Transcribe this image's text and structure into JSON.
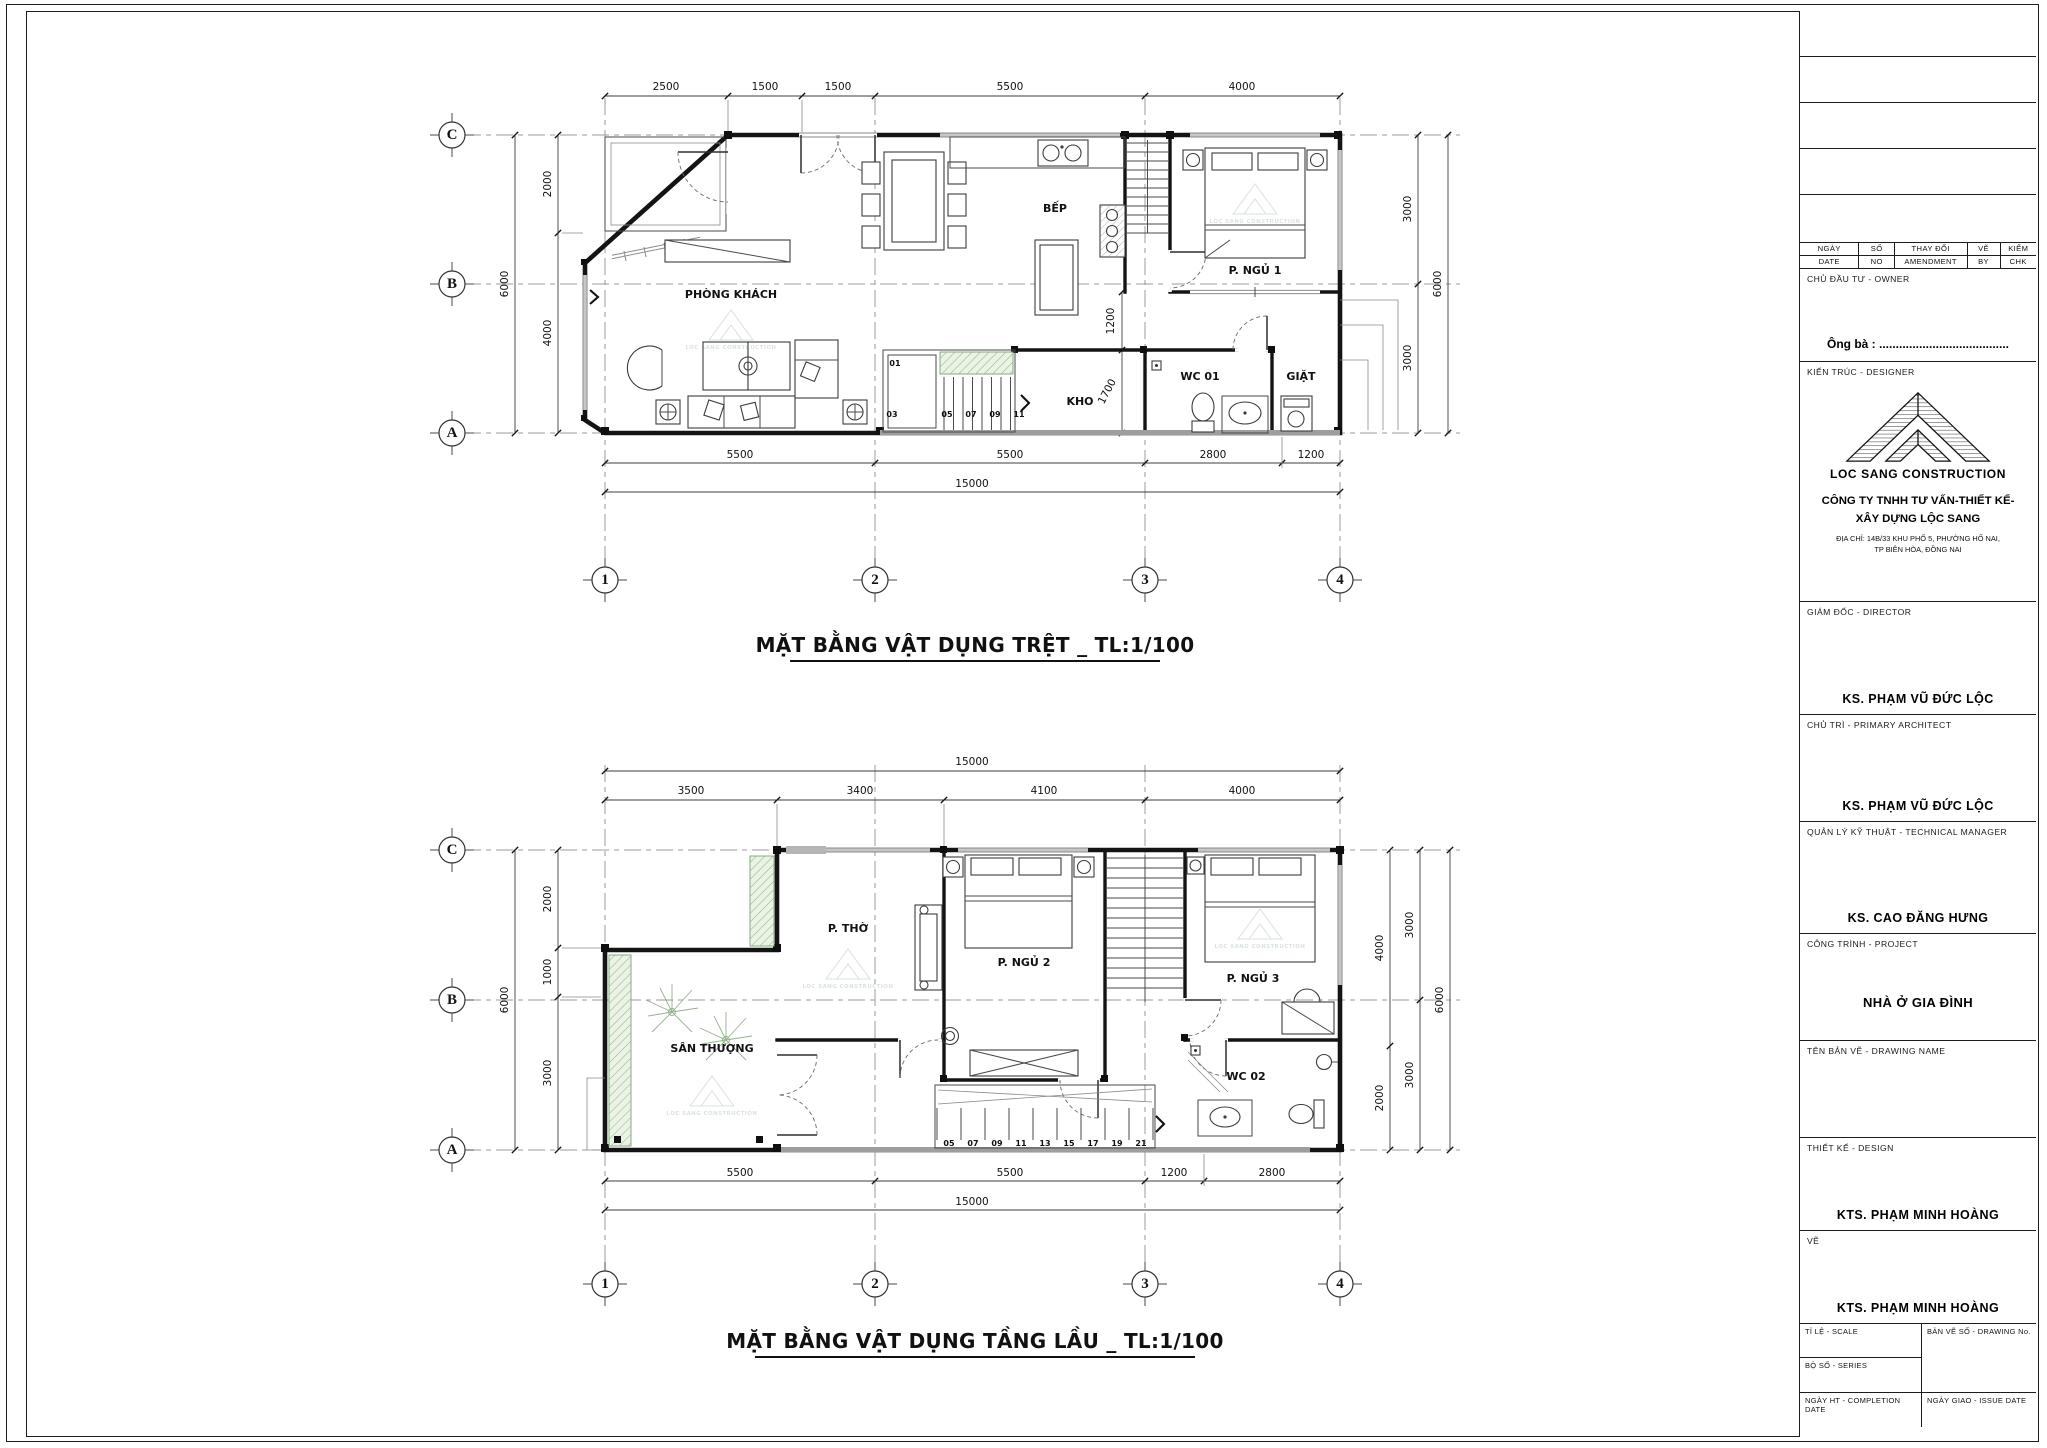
{
  "titles": {
    "plan1": "MẶT BẰNG VẬT DỤNG TRỆT _ TL:1/100",
    "plan2": "MẶT BẰNG VẬT DỤNG TẦNG LẦU _ TL:1/100"
  },
  "watermark": "LOC SANG CONSTRUCTION",
  "grid": {
    "rows": [
      "C",
      "B",
      "A"
    ],
    "cols": [
      "1",
      "2",
      "3",
      "4"
    ]
  },
  "plan1": {
    "rooms": {
      "living": "PHÒNG KHÁCH",
      "kitchen": "BẾP",
      "bed1": "P. NGỦ 1",
      "storage": "KHO",
      "wc": "WC 01",
      "laundry": "GIẶT"
    },
    "dims": {
      "top": [
        "2500",
        "1500",
        "1500",
        "5500",
        "4000"
      ],
      "bottom": [
        "5500",
        "5500",
        "2800",
        "1200"
      ],
      "bottom_total": "15000",
      "left": [
        "2000",
        "4000"
      ],
      "left_total": "6000",
      "right": [
        "3000",
        "3000"
      ],
      "right_total": "6000",
      "inner": [
        "1200",
        "1700"
      ]
    },
    "stairs": [
      "01",
      "03",
      "05",
      "07",
      "09",
      "11"
    ]
  },
  "plan2": {
    "rooms": {
      "altar": "P. THỜ",
      "bed2": "P. NGỦ 2",
      "bed3": "P. NGỦ 3",
      "terrace": "SÂN THƯỢNG",
      "wc": "WC 02"
    },
    "dims": {
      "top_total": "15000",
      "top": [
        "3500",
        "3400",
        "4100",
        "4000"
      ],
      "bottom": [
        "5500",
        "5500",
        "1200",
        "2800"
      ],
      "bottom_total": "15000",
      "left": [
        "2000",
        "1000",
        "3000"
      ],
      "left_total": "6000",
      "right_inner": [
        "4000",
        "2000"
      ],
      "right": [
        "3000",
        "3000"
      ],
      "right_total": "6000"
    },
    "stairs": [
      "05",
      "07",
      "09",
      "11",
      "13",
      "15",
      "17",
      "19",
      "21"
    ]
  },
  "titleblock": {
    "rev_vn": [
      "NGÀY",
      "SỐ",
      "THAY ĐỔI",
      "VẼ",
      "KIỂM"
    ],
    "rev_en": [
      "DATE",
      "NO",
      "AMENDMENT",
      "BY",
      "CHK"
    ],
    "owner_label": "CHỦ ĐẦU TƯ - OWNER",
    "owner_value": "Ông bà : .......................................",
    "designer_label": "KIẾN TRÚC - DESIGNER",
    "logo_text": "LOC SANG CONSTRUCTION",
    "company_line1": "CÔNG TY TNHH TƯ VẤN-THIẾT KẾ-",
    "company_line2": "XÂY DỰNG LỘC SANG",
    "address_line1": "ĐỊA CHỈ: 14B/33 KHU PHỐ 5, PHƯỜNG HỐ NAI,",
    "address_line2": "TP BIÊN HÒA, ĐỒNG NAI",
    "director_label": "GIÁM ĐỐC - DIRECTOR",
    "director_name": "KS. PHẠM VŨ ĐỨC LỘC",
    "primary_label": "CHỦ TRÌ - PRIMARY ARCHITECT",
    "primary_name": "KS. PHẠM VŨ ĐỨC LỘC",
    "tech_label": "QUẢN LÝ KỸ THUẬT - TECHNICAL MANAGER",
    "tech_name": "KS. CAO ĐĂNG HƯNG",
    "project_label": "CÔNG TRÌNH - PROJECT",
    "project_name": "NHÀ Ở GIA ĐÌNH",
    "drawingname_label": "TÊN BẢN VẼ - DRAWING NAME",
    "design_label": "THIẾT KẾ - DESIGN",
    "design_name": "KTS. PHẠM MINH HOÀNG",
    "draw_label": "VẼ",
    "draw_name": "KTS. PHẠM MINH HOÀNG",
    "scale_label": "TỈ LỆ - SCALE",
    "series_label": "BỘ SỐ - SERIES",
    "completion_label": "NGÀY HT - COMPLETION DATE",
    "drawno_label": "BẢN VẼ SỐ  - DRAWING No.",
    "issue_label": "NGÀY GIAO - ISSUE DATE"
  }
}
